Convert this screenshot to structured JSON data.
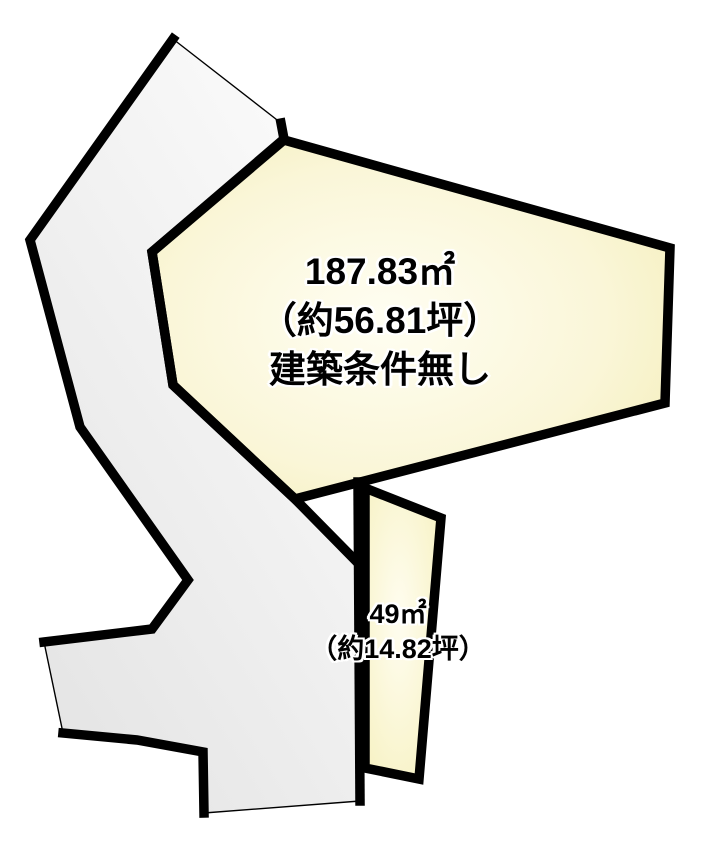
{
  "colors": {
    "ink": "#000000",
    "background": "#ffffff",
    "road_fill_light": "#fcfcfc",
    "road_fill_dark": "#e4e4e4",
    "parcel_fill_center": "#fffef2",
    "parcel_fill_mid": "#faf6d8",
    "parcel_fill_edge": "#f1eaa8",
    "sub_fill_center": "#fffdf0",
    "sub_fill_edge": "#f4eeb4",
    "label_halo": "#ffffff"
  },
  "shapes": {
    "road_outline": "173,39 281,123 284,139 152,252 173,385 295,499 356,561 360,801 204,813 203,752 137,740 63,733 44,642 152,629 188,580 80,427 30,240",
    "road_edge_right": "281,123 284,139 152,252 173,385 295,499 356,561",
    "road_edge_vertical": "358,482 360,801",
    "road_edge_bottom_step": "204,813 203,752 137,740 63,733",
    "road_edge_left": "44,642 152,629 188,580 80,427 30,240 173,39",
    "road_edge_thin_top": "173,39 281,123",
    "road_edge_thin_west": "63,733 44,642",
    "road_edge_thin_south": "360,801 204,813",
    "main_parcel": "284,140 670,248 665,403 295,499 173,385 152,252",
    "sub_parcel": "365,488 441,518 419,779 365,768"
  },
  "labels": {
    "main": {
      "area": "187.83㎡",
      "tsubo": "（約56.81坪）",
      "note": "建築条件無し"
    },
    "sub": {
      "area": "49㎡",
      "tsubo": "（約14.82坪）"
    }
  }
}
